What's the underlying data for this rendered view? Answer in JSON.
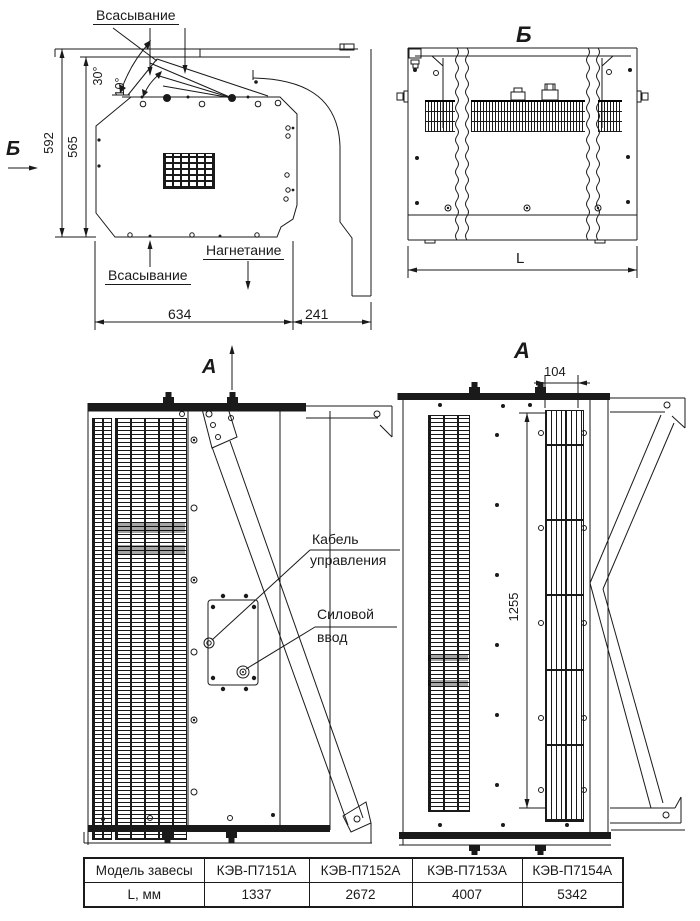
{
  "drawing": {
    "side_view": {
      "suction_top_label": "Всасывание",
      "suction_bottom_label": "Всасывание",
      "discharge_label": "Нагнетание",
      "height_overall": "592",
      "height_body": "565",
      "angle_max": "30°",
      "angle_min": "10°",
      "width_body": "634",
      "bracket_depth": "241",
      "section_marker_b": "Б",
      "section_marker_a": "А"
    },
    "view_b": {
      "title": "Б",
      "length_dim": "L"
    },
    "front_view": {
      "control_cable_line1": "Кабель",
      "control_cable_line2": "управления",
      "power_input_line1": "Силовой",
      "power_input_line2": "ввод"
    },
    "view_a": {
      "title": "А",
      "outlet_width": "104",
      "outlet_length": "1255"
    }
  },
  "table": {
    "header_label": "Модель завесы",
    "models": [
      "КЭВ-П7151А",
      "КЭВ-П7152А",
      "КЭВ-П7153А",
      "КЭВ-П7154А"
    ],
    "row_label": "L, мм",
    "lengths": [
      "1337",
      "2672",
      "4007",
      "5342"
    ]
  },
  "colors": {
    "line": "#1a1a1a",
    "background": "#ffffff"
  }
}
